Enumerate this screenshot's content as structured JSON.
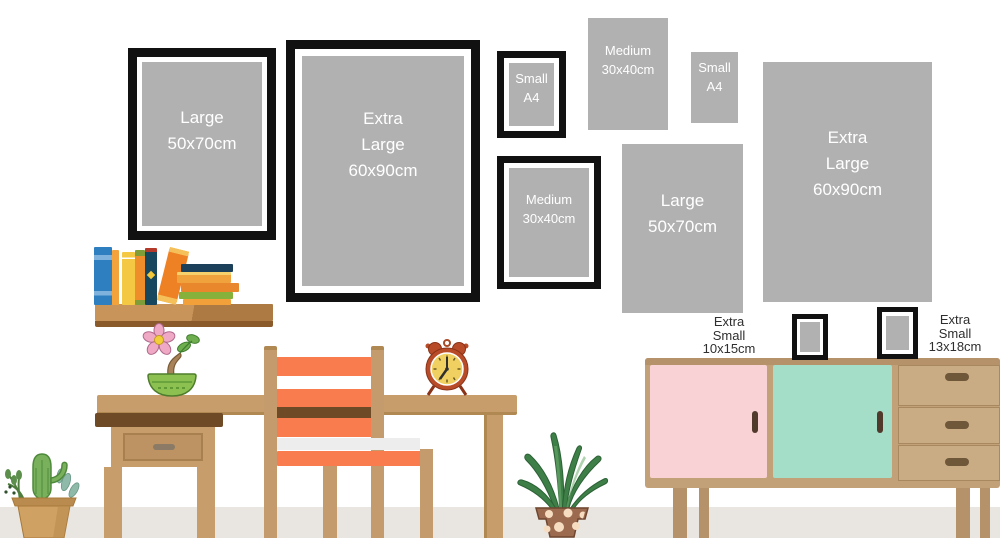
{
  "wall_frames": {
    "framed_large": {
      "lines": [
        "Large",
        "50x70cm"
      ]
    },
    "framed_extra_large": {
      "lines": [
        "Extra",
        "Large",
        "60x90cm"
      ]
    },
    "framed_small_a4": {
      "lines": [
        "Small",
        "A4"
      ]
    },
    "print_medium": {
      "lines": [
        "Medium",
        "30x40cm"
      ]
    },
    "print_small_a4": {
      "lines": [
        "Small",
        "A4"
      ]
    },
    "framed_medium": {
      "lines": [
        "Medium",
        "30x40cm"
      ]
    },
    "print_large": {
      "lines": [
        "Large",
        "50x70cm"
      ]
    },
    "print_extra_large": {
      "lines": [
        "Extra",
        "Large",
        "60x90cm"
      ]
    }
  },
  "floor_labels": {
    "extra_small_10x15": {
      "lines": [
        "Extra",
        "Small",
        "10x15cm"
      ]
    },
    "extra_small_13x18": {
      "lines": [
        "Extra",
        "Small",
        "13x18cm"
      ]
    }
  },
  "colors": {
    "frame_black": "#111111",
    "print_gray": "#b1b1b1",
    "mat_white": "#ffffff",
    "print_text": "#ffffff",
    "label_text": "#2f2f2f",
    "wood_tan": "#c79d6b",
    "wood_dark_edge": "#6f4a26",
    "shelf_brown": "#c9945a",
    "chair_orange": "#f97c4e",
    "cabinet_tan": "#c3a178",
    "door_pink": "#f8d2d4",
    "door_mint": "#a4ddc8",
    "floor_gray": "#e9e6e1"
  },
  "decor_items": [
    "bookshelf-with-books",
    "flower-pot-plant",
    "alarm-clock",
    "desk-with-drawer",
    "chair",
    "aloe-plant",
    "cactus-pot-plant",
    "sideboard"
  ]
}
